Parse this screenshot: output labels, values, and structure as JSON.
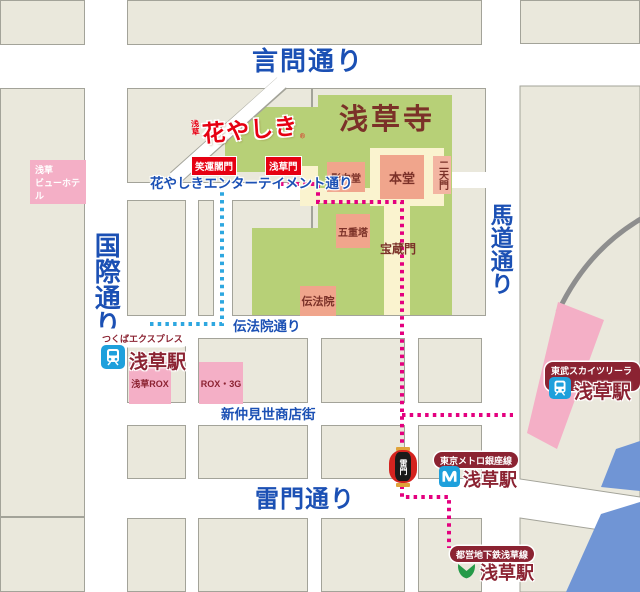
{
  "colors": {
    "route-pink": "#e4007f",
    "route-blue": "#2ea7e0",
    "street-blue": "#1b50b4",
    "station-maroon": "#8b2332",
    "temple-brown": "#7b3128",
    "gate-red": "#e60012",
    "green": "#b7d077",
    "yellow": "#faf3cf",
    "salmon": "#f0a58c",
    "salmon-light": "#f3b5a2",
    "pink": "#f4afc6",
    "river": "#7095d5",
    "block": "#eae8dc",
    "block-border": "#a3a399",
    "icon-blue": "#1ea0dc",
    "toei-green": "#259a48",
    "rail-gray": "#8e8e8e",
    "lantern-red": "#d4231f",
    "lantern-gold": "#e0a33a"
  },
  "streets": {
    "kototoi": "言問通り",
    "kokusai": "国際通り",
    "umamichi": "馬道通り",
    "kaminarimon_dori": "雷門通り",
    "entertainment": "花やしきエンターテイメント通り",
    "denboin_dori": "伝法院通り",
    "shin_nakamise": "新仲見世商店街"
  },
  "temple": {
    "name": "浅草寺",
    "main_hall": "本堂",
    "yogodo": "影向堂",
    "nitenmon": "二天門",
    "pagoda": "五重塔",
    "hozomon": "宝蔵門",
    "denboin_hall": "伝法院"
  },
  "hanayashiki": {
    "prefix": "浅草",
    "logo": "花やしき",
    "reg": "®",
    "gates": {
      "shounkaku": "笑運閣門",
      "asakusa": "浅草門"
    }
  },
  "places": {
    "hotel_line1": "浅草",
    "hotel_line2": "ビューホテル",
    "rox": "浅草ROX",
    "rox3g": "ROX・3G"
  },
  "landmark": {
    "kaminarimon": "雷門"
  },
  "stations": {
    "tx": {
      "line": "つくばエクスプレス",
      "name": "浅草駅"
    },
    "tobu": {
      "line": "東武スカイツリーライン",
      "name": "浅草駅"
    },
    "metro": {
      "line": "東京メトロ銀座線",
      "name": "浅草駅"
    },
    "toei": {
      "line": "都営地下鉄浅草線",
      "name": "浅草駅"
    }
  }
}
